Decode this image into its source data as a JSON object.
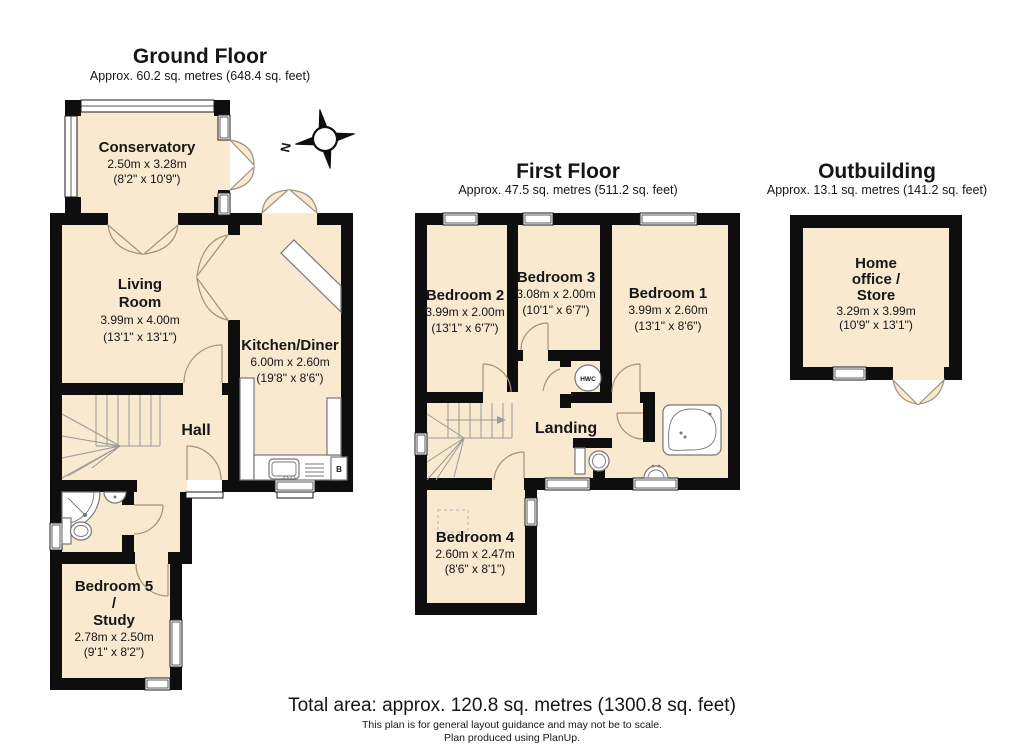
{
  "colors": {
    "wall": "#0e0e0e",
    "room_fill": "#f8e9cf",
    "door_arc": "#a5907a",
    "fixture_outline": "#777777"
  },
  "ground_floor": {
    "title": "Ground Floor",
    "subtitle": "Approx. 60.2 sq. metres (648.4 sq. feet)",
    "rooms": {
      "conservatory": {
        "lines": [
          "Conservatory"
        ],
        "dims": "2.50m x 3.28m",
        "dims_ft": "(8'2\" x 10'9\")"
      },
      "living_room": {
        "lines": [
          "Living",
          "Room"
        ],
        "dims": "3.99m x 4.00m",
        "dims_ft": "(13'1\" x 13'1\")"
      },
      "kitchen_diner": {
        "lines": [
          "Kitchen/Diner"
        ],
        "dims": "6.00m x 2.60m",
        "dims_ft": "(19'8\" x 8'6\")"
      },
      "hall": {
        "lines": [
          "Hall"
        ]
      },
      "bedroom5_study": {
        "lines": [
          "Bedroom 5",
          "/",
          "Study"
        ],
        "dims": "2.78m x 2.50m",
        "dims_ft": "(9'1\" x 8'2\")"
      }
    },
    "boiler_label": "B"
  },
  "first_floor": {
    "title": "First Floor",
    "subtitle": "Approx. 47.5 sq. metres (511.2 sq. feet)",
    "rooms": {
      "bedroom2": {
        "lines": [
          "Bedroom 2"
        ],
        "dims": "3.99m x 2.00m",
        "dims_ft": "(13'1\" x 6'7\")"
      },
      "bedroom3": {
        "lines": [
          "Bedroom 3"
        ],
        "dims": "3.08m x 2.00m",
        "dims_ft": "(10'1\" x 6'7\")"
      },
      "bedroom1": {
        "lines": [
          "Bedroom 1"
        ],
        "dims": "3.99m x 2.60m",
        "dims_ft": "(13'1\" x 8'6\")"
      },
      "landing": {
        "lines": [
          "Landing"
        ]
      },
      "bedroom4": {
        "lines": [
          "Bedroom 4"
        ],
        "dims": "2.60m x 2.47m",
        "dims_ft": "(8'6\" x 8'1\")"
      }
    },
    "hwc_label": "HWC"
  },
  "outbuilding": {
    "title": "Outbuilding",
    "subtitle": "Approx. 13.1 sq. metres (141.2 sq. feet)",
    "rooms": {
      "home_office_store": {
        "lines": [
          "Home",
          "office /",
          "Store"
        ],
        "dims": "3.29m x 3.99m",
        "dims_ft": "(10'9\" x 13'1\")"
      }
    }
  },
  "compass": {
    "north_label": "N"
  },
  "footer": {
    "total_area": "Total area: approx. 120.8 sq. metres (1300.8 sq. feet)",
    "disclaimer": "This plan is for general layout guidance and may not be to scale.",
    "credit": "Plan produced using PlanUp."
  }
}
